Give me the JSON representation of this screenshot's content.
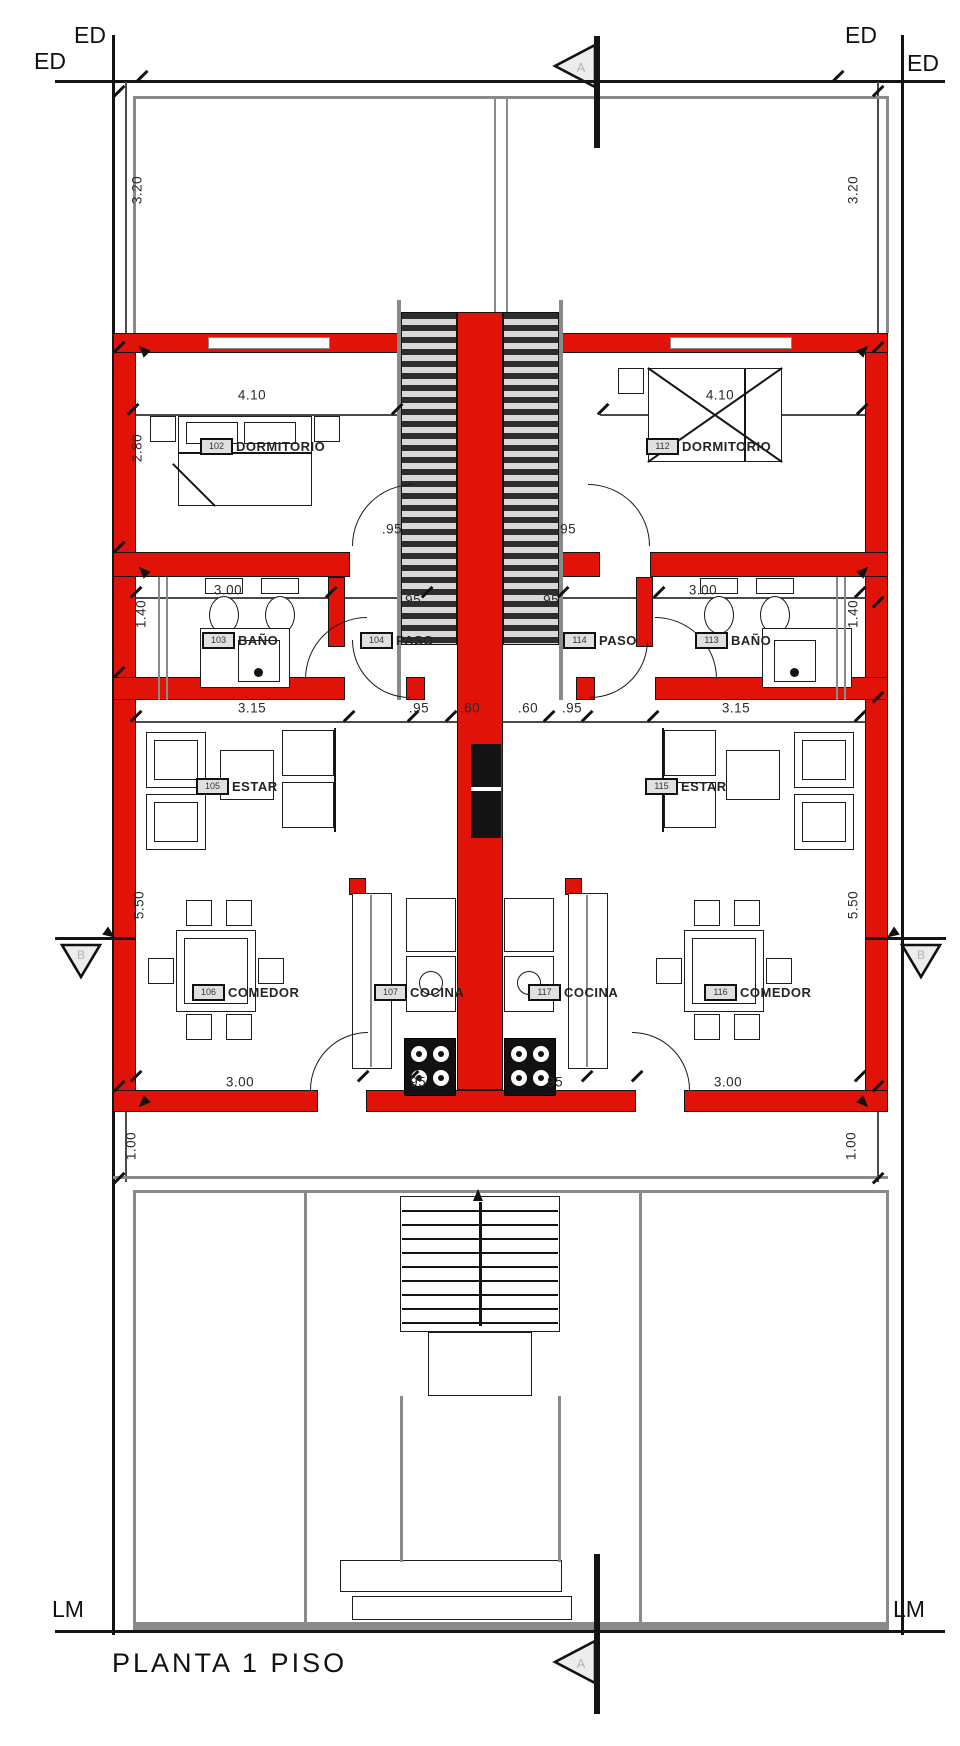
{
  "drawing": {
    "title": "PLANTA 1 PISO"
  },
  "boundary": {
    "ed_top_left_inner": "ED",
    "ed_top_left_outer": "ED",
    "ed_top_right_inner": "ED",
    "ed_top_right_outer": "ED",
    "lm_left": "LM",
    "lm_right": "LM"
  },
  "section_markers": {
    "top": "A",
    "bottom": "A",
    "left": "B",
    "right": "B"
  },
  "colors": {
    "wall_red": "#e11309",
    "line_black": "#141414",
    "line_gray": "#8a8a8a"
  },
  "rooms": [
    {
      "tag": "102",
      "name": "DORMITORIO",
      "unit": "left",
      "box_x": 200,
      "box_y": 438,
      "text_x": 236
    },
    {
      "tag": "103",
      "name": "BAÑO",
      "unit": "left",
      "box_x": 202,
      "box_y": 632,
      "text_x": 238
    },
    {
      "tag": "104",
      "name": "PASO",
      "unit": "left",
      "box_x": 360,
      "box_y": 632,
      "text_x": 396
    },
    {
      "tag": "105",
      "name": "ESTAR",
      "unit": "left",
      "box_x": 196,
      "box_y": 778,
      "text_x": 232
    },
    {
      "tag": "106",
      "name": "COMEDOR",
      "unit": "left",
      "box_x": 192,
      "box_y": 984,
      "text_x": 228
    },
    {
      "tag": "107",
      "name": "COCINA",
      "unit": "left",
      "box_x": 374,
      "box_y": 984,
      "text_x": 410
    },
    {
      "tag": "112",
      "name": "DORMITORIO",
      "unit": "right",
      "box_x": 646,
      "box_y": 438,
      "text_x": 682
    },
    {
      "tag": "113",
      "name": "BAÑO",
      "unit": "right",
      "box_x": 695,
      "box_y": 632,
      "text_x": 731
    },
    {
      "tag": "114",
      "name": "PASO",
      "unit": "right",
      "box_x": 563,
      "box_y": 632,
      "text_x": 599
    },
    {
      "tag": "115",
      "name": "ESTAR",
      "unit": "right",
      "box_x": 645,
      "box_y": 778,
      "text_x": 681
    },
    {
      "tag": "116",
      "name": "COMEDOR",
      "unit": "right",
      "box_x": 704,
      "box_y": 984,
      "text_x": 740
    },
    {
      "tag": "117",
      "name": "COCINA",
      "unit": "right",
      "box_x": 528,
      "box_y": 984,
      "text_x": 564
    }
  ],
  "dimensions": {
    "horizontal": [
      {
        "value": "4.10",
        "x": 252,
        "y": 395
      },
      {
        "value": "4.10",
        "x": 720,
        "y": 395
      },
      {
        "value": ".95",
        "x": 392,
        "y": 529
      },
      {
        "value": ".95",
        "x": 566,
        "y": 529
      },
      {
        "value": "3.00",
        "x": 228,
        "y": 590
      },
      {
        "value": ".95",
        "x": 411,
        "y": 600
      },
      {
        "value": ".95",
        "x": 549,
        "y": 600
      },
      {
        "value": "3.00",
        "x": 703,
        "y": 590
      },
      {
        "value": "3.15",
        "x": 252,
        "y": 708
      },
      {
        "value": ".95",
        "x": 419,
        "y": 708
      },
      {
        "value": ".60",
        "x": 470,
        "y": 708
      },
      {
        "value": ".60",
        "x": 528,
        "y": 708
      },
      {
        "value": ".95",
        "x": 572,
        "y": 708
      },
      {
        "value": "3.15",
        "x": 736,
        "y": 708
      },
      {
        "value": "3.00",
        "x": 240,
        "y": 1082
      },
      {
        "value": ".95",
        "x": 416,
        "y": 1082
      },
      {
        "value": ".95",
        "x": 553,
        "y": 1082
      },
      {
        "value": "3.00",
        "x": 728,
        "y": 1082
      }
    ],
    "vertical": [
      {
        "value": "3.20",
        "x": 137,
        "y": 190
      },
      {
        "value": "3.20",
        "x": 853,
        "y": 190
      },
      {
        "value": "2.80",
        "x": 137,
        "y": 448
      },
      {
        "value": "1.40",
        "x": 141,
        "y": 614
      },
      {
        "value": "1.40",
        "x": 853,
        "y": 614
      },
      {
        "value": "5.50",
        "x": 139,
        "y": 905
      },
      {
        "value": "5.50",
        "x": 853,
        "y": 905
      },
      {
        "value": "1.00",
        "x": 131,
        "y": 1146
      },
      {
        "value": "1.00",
        "x": 851,
        "y": 1146
      }
    ]
  }
}
